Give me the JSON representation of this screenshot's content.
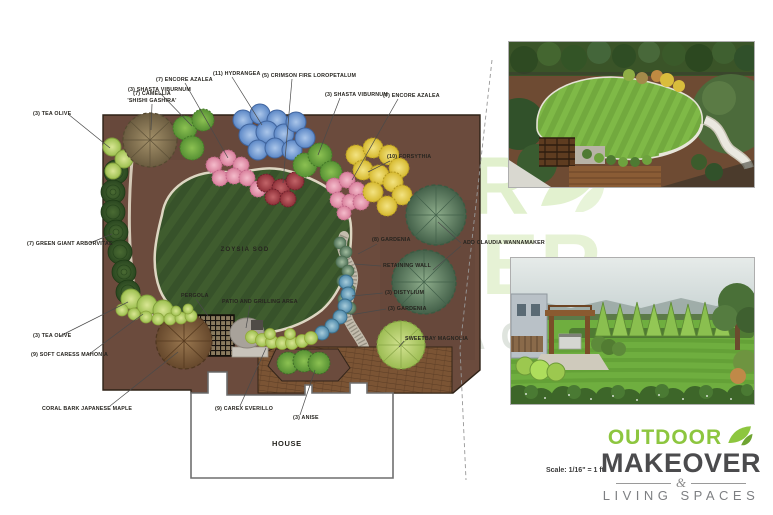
{
  "plan": {
    "labels": [
      {
        "text": "(3) TEA OLIVE"
      },
      {
        "text": "(7) CAMELLIA",
        "line2": "'SHISHI GASHIRA'"
      },
      {
        "text": "(3) SHASTA VIBURNUM"
      },
      {
        "text": "(7) ENCORE AZALEA"
      },
      {
        "text": "(11) HYDRANGEA"
      },
      {
        "text": "(5) CRIMSON FIRE LOROPETALUM"
      },
      {
        "text": "(3) SHASTA VIBURNUM"
      },
      {
        "text": "(7) ENCORE AZALEA"
      },
      {
        "text": "(10) FORSYTHIA"
      },
      {
        "text": "(7) GREEN GIANT ARBORVITAE"
      },
      {
        "text": "(8) GARDENIA"
      },
      {
        "text": "ADD CLAUDIA WANNAMAKER"
      },
      {
        "text": "RETAINING WALL"
      },
      {
        "text": "(3) DISTYLIUM"
      },
      {
        "text": "(3) GARDENIA"
      },
      {
        "text": "SWEETBAY MAGNOLIA"
      },
      {
        "text": "ZOYSIA SOD"
      },
      {
        "text": "PERGOLA"
      },
      {
        "text": "PATIO AND GRILLING AREA"
      },
      {
        "text": "(3) TEA OLIVE"
      },
      {
        "text": "(9) SOFT CARESS MAHONIA"
      },
      {
        "text": "CORAL BARK JAPANESE MAPLE"
      },
      {
        "text": "(9) CAREX EVERILLO"
      },
      {
        "text": "(3) ANISE"
      },
      {
        "text": "HOUSE"
      }
    ]
  },
  "logo": {
    "outdoor": "OUTDOOR",
    "makeover": "MAKEOVER",
    "ampersand": "&",
    "living_spaces": "LIVING SPACES"
  },
  "scale_note": "Scale: 1/16\" = 1 ft",
  "colors": {
    "logo_green": "#8dc63f",
    "logo_dark": "#4b4b4d",
    "logo_gray": "#7d7f82",
    "plan_soil_brown": "#6b4b3d",
    "lawn_green": "#3f5c2e",
    "hydrangea_blue": "#6d97d3",
    "azalea_pink": "#e795ad",
    "forsythia_yellow": "#dfc63f",
    "loropetalum_crimson": "#a8404d"
  }
}
